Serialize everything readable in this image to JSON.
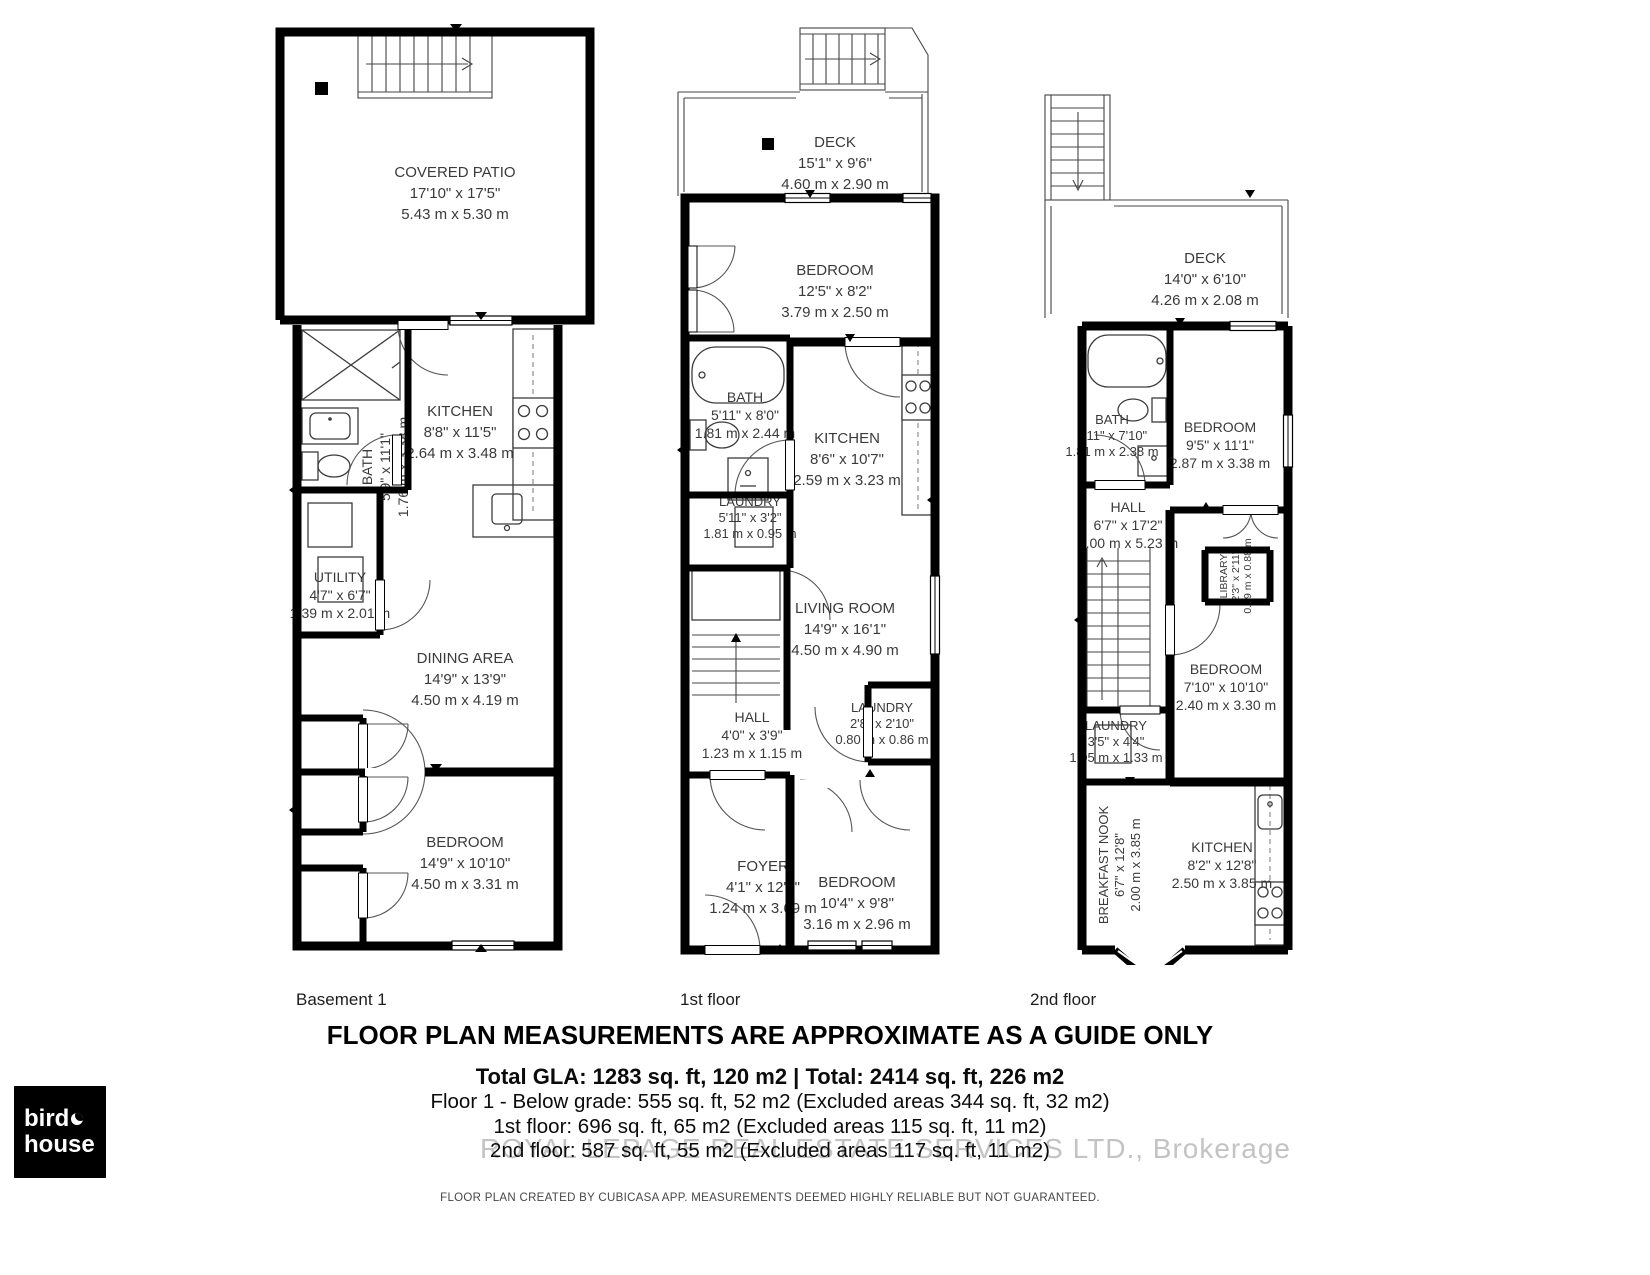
{
  "floors": [
    {
      "label": "Basement 1",
      "rooms": [
        {
          "name": "COVERED PATIO",
          "ft": "17'10\" x 17'5\"",
          "m": "5.43 m x 5.30 m"
        },
        {
          "name": "KITCHEN",
          "ft": "8'8\" x 11'5\"",
          "m": "2.64 m x 3.48 m"
        },
        {
          "name": "BATH",
          "ft": "5'9\" x 11'1\"",
          "m": "1.76 m x 3.38 m"
        },
        {
          "name": "UTILITY",
          "ft": "4'7\" x 6'7\"",
          "m": "1.39 m x 2.01 m"
        },
        {
          "name": "DINING AREA",
          "ft": "14'9\" x 13'9\"",
          "m": "4.50 m x 4.19 m"
        },
        {
          "name": "BEDROOM",
          "ft": "14'9\" x 10'10\"",
          "m": "4.50 m x 3.31 m"
        }
      ]
    },
    {
      "label": "1st floor",
      "rooms": [
        {
          "name": "DECK",
          "ft": "15'1\" x 9'6\"",
          "m": "4.60 m x 2.90 m"
        },
        {
          "name": "BEDROOM",
          "ft": "12'5\" x 8'2\"",
          "m": "3.79 m x 2.50 m"
        },
        {
          "name": "BATH",
          "ft": "5'11\" x 8'0\"",
          "m": "1.81 m x 2.44 m"
        },
        {
          "name": "LAUNDRY",
          "ft": "5'11\" x 3'2\"",
          "m": "1.81 m x 0.95 m"
        },
        {
          "name": "KITCHEN",
          "ft": "8'6\" x 10'7\"",
          "m": "2.59 m x 3.23 m"
        },
        {
          "name": "LIVING ROOM",
          "ft": "14'9\" x 16'1\"",
          "m": "4.50 m x 4.90 m"
        },
        {
          "name": "HALL",
          "ft": "4'0\" x 3'9\"",
          "m": "1.23 m x 1.15 m"
        },
        {
          "name": "LAUNDRY",
          "ft": "2'8\" x 2'10\"",
          "m": "0.80 m x 0.86 m"
        },
        {
          "name": "FOYER",
          "ft": "4'1\" x 12'1\"",
          "m": "1.24 m x 3.69 m"
        },
        {
          "name": "BEDROOM",
          "ft": "10'4\" x 9'8\"",
          "m": "3.16 m x 2.96 m"
        }
      ]
    },
    {
      "label": "2nd floor",
      "rooms": [
        {
          "name": "DECK",
          "ft": "14'0\" x 6'10\"",
          "m": "4.26 m x 2.08 m"
        },
        {
          "name": "BATH",
          "ft": "5'11\" x 7'10\"",
          "m": "1.81 m x 2.38 m"
        },
        {
          "name": "BEDROOM",
          "ft": "9'5\" x 11'1\"",
          "m": "2.87 m x 3.38 m"
        },
        {
          "name": "HALL",
          "ft": "6'7\" x 17'2\"",
          "m": "2.00 m x 5.23 m"
        },
        {
          "name": "LIBRARY",
          "ft": "2'3\" x 2'11\"",
          "m": "0.69 m x 0.88 m"
        },
        {
          "name": "BEDROOM",
          "ft": "7'10\" x 10'10\"",
          "m": "2.40 m x 3.30 m"
        },
        {
          "name": "LAUNDRY",
          "ft": "3'5\" x 4'4\"",
          "m": "1.05 m x 1.33 m"
        },
        {
          "name": "BREAKFAST NOOK",
          "ft": "6'7\" x 12'8\"",
          "m": "2.00 m x 3.85 m"
        },
        {
          "name": "KITCHEN",
          "ft": "8'2\" x 12'8\"",
          "m": "2.50 m x 3.85 m"
        }
      ]
    }
  ],
  "footer": {
    "title": "FLOOR PLAN MEASUREMENTS ARE APPROXIMATE AS A GUIDE ONLY",
    "total_line": "Total GLA: 1283 sq. ft, 120 m2 | Total: 2414 sq. ft, 226 m2",
    "floor1_line": "Floor 1 - Below grade: 555 sq. ft, 52 m2 (Excluded areas 344 sq. ft, 32 m2)",
    "floor2_line": "1st floor: 696 sq. ft, 65 m2 (Excluded areas 115 sq. ft, 11 m2)",
    "floor3_line": "2nd floor: 587 sq. ft, 55 m2 (Excluded areas 117 sq. ft, 11 m2)",
    "watermark": "ROYAL LEPAGE REAL ESTATE SERVICES LTD., Brokerage",
    "credit": "FLOOR PLAN CREATED BY CUBICASA APP. MEASUREMENTS DEEMED HIGHLY RELIABLE BUT NOT GUARANTEED."
  },
  "logo": {
    "line1": "bird",
    "line2": "house"
  }
}
